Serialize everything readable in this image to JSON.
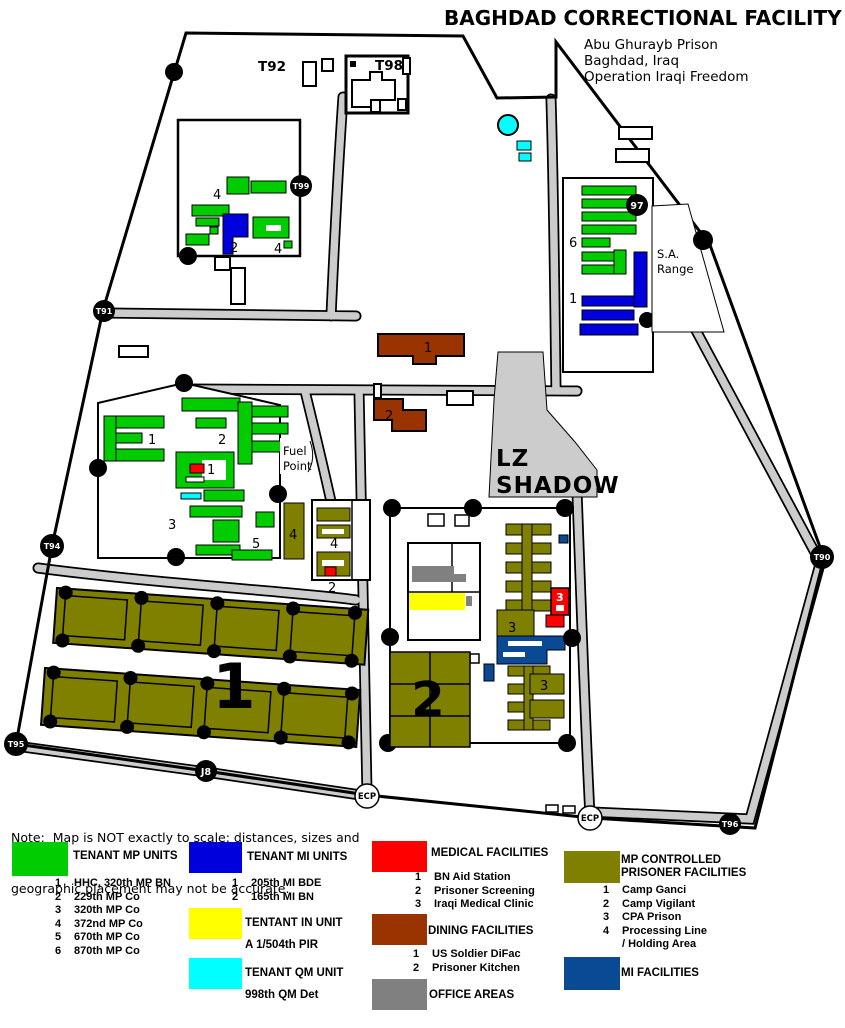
{
  "title": "BAGHDAD CORRECTIONAL FACILITY",
  "subtitle_lines": [
    "Abu Ghurayb Prison",
    "Baghdad, Iraq",
    "Operation Iraqi Freedom"
  ],
  "note_lines": [
    "Note:  Map is NOT exactly to scale; distances, sizes and",
    "geographic placement may not be accurate."
  ],
  "colors": {
    "green": "#00CC00",
    "blue": "#0000DD",
    "yellow": "#FFFF00",
    "cyan": "#00FFFF",
    "red": "#FF0000",
    "brown": "#993300",
    "gray": "#808080",
    "olive": "#808000",
    "navy": "#0A4A94",
    "road": "#CCCCCC"
  },
  "map": {
    "labels": {
      "t92": "T92",
      "t98": "T98",
      "lz_line1": "LZ",
      "lz_line2": "SHADOW",
      "fuel_line1": "Fuel",
      "fuel_line2": "Point",
      "sa_line1": "S.A.",
      "sa_line2": "Range"
    },
    "markers": {
      "t99": "T99",
      "t91": "T91",
      "t94": "T94",
      "t95": "T95",
      "j8": "J8",
      "p97": "97",
      "t90": "T90",
      "t96": "T96",
      "ecp_west": "ECP",
      "ecp_south": "ECP"
    },
    "numbers": {
      "nw_upper": "4",
      "nw_mi": "2",
      "nw_right": "4",
      "ne_mp": "6",
      "ne_mi": "1",
      "camp_mp1": "1",
      "camp_mp2": "2",
      "camp_aid": "1",
      "camp_mp3": "3",
      "camp_mp5": "5",
      "camp_proc": "4",
      "proc_bldg": "4",
      "proc_screen": "2",
      "difac": "1",
      "kitchen": "2",
      "cpa_upper": "3",
      "cpa_lower": "3",
      "clinic": "3",
      "ganci": "1",
      "vigilant": "2"
    }
  },
  "legend": {
    "mp_units": {
      "title": "TENANT MP UNITS",
      "items": [
        [
          "1",
          "HHC, 320th MP BN"
        ],
        [
          "2",
          "229th MP Co"
        ],
        [
          "3",
          "320th MP Co"
        ],
        [
          "4",
          "372nd MP Co"
        ],
        [
          "5",
          "670th MP Co"
        ],
        [
          "6",
          "870th MP Co"
        ]
      ]
    },
    "mi_units": {
      "title": "TENANT MI UNITS",
      "items": [
        [
          "1",
          "205th MI BDE"
        ],
        [
          "2",
          "165th MI BN"
        ]
      ]
    },
    "in_unit": {
      "title": "TENTANT IN UNIT",
      "detail": "A 1/504th PIR"
    },
    "qm_unit": {
      "title": "TENANT QM UNIT",
      "detail": "998th QM Det"
    },
    "medical": {
      "title": "MEDICAL FACILITIES",
      "items": [
        [
          "1",
          "BN Aid Station"
        ],
        [
          "2",
          "Prisoner Screening"
        ],
        [
          "3",
          "Iraqi Medical Clinic"
        ]
      ]
    },
    "dining": {
      "title": "DINING FACILITIES",
      "items": [
        [
          "1",
          "US Soldier DiFac"
        ],
        [
          "2",
          "Prisoner Kitchen"
        ]
      ]
    },
    "office": {
      "title": "OFFICE AREAS"
    },
    "prisoner": {
      "title_line1": "MP CONTROLLED",
      "title_line2": "PRISONER FACILITIES",
      "items": [
        [
          "1",
          "Camp Ganci"
        ],
        [
          "2",
          "Camp Vigilant"
        ],
        [
          "3",
          "CPA Prison"
        ],
        [
          "4",
          "Processing Line"
        ],
        [
          "",
          "/ Holding Area"
        ]
      ]
    },
    "mi_fac": {
      "title": "MI FACILITIES"
    }
  }
}
